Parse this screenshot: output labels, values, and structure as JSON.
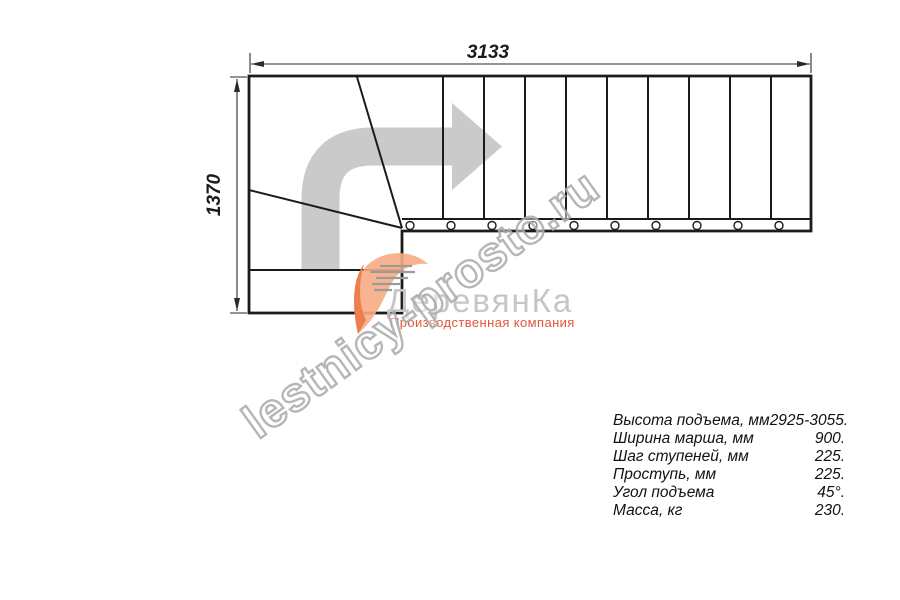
{
  "drawing": {
    "dimension_top": "3133",
    "dimension_left": "1370",
    "line_color": "#1b1b1b",
    "dim_color": "#2a2a2a",
    "direction_arrow_icon": "quarter-turn-right-arrow",
    "arrow_color": "#cacaca"
  },
  "watermark": {
    "text": "lestnicy-prosto.ru",
    "stroke_color": "#a9a9a9"
  },
  "logo": {
    "mark_icon": "swoosh-leaf-icon",
    "wordmark": "ДеревянКа",
    "caption": "Производственная компания",
    "wordmark_color": "#c6c6c6",
    "caption_color": "#e2573a",
    "mark_color_light": "#f6ac83",
    "mark_color_dark": "#ee7e4e"
  },
  "specs": {
    "rows": [
      {
        "label": "Высота подъема, мм",
        "value": "2925-3055."
      },
      {
        "label": "Ширина марша, мм",
        "value": "900."
      },
      {
        "label": "Шаг ступеней, мм",
        "value": "225."
      },
      {
        "label": "Проступь, мм",
        "value": "225."
      },
      {
        "label": "Угол подъема",
        "value": "45°."
      },
      {
        "label": "Масса, кг",
        "value": "230."
      }
    ]
  }
}
